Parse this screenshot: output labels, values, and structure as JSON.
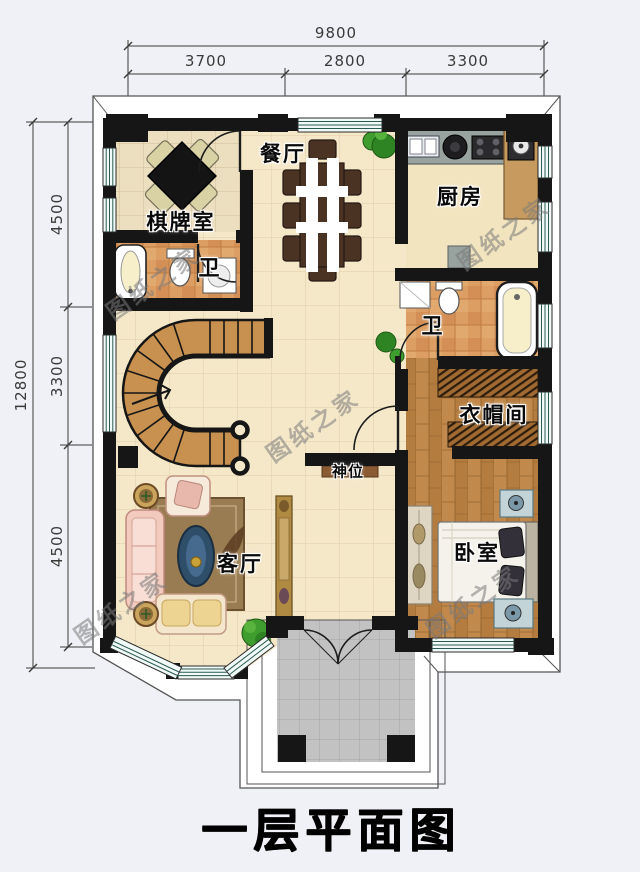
{
  "title": {
    "text": "一层平面图"
  },
  "watermark": {
    "text": "图纸之家",
    "color": "#7a7a7a"
  },
  "dimensions": {
    "top": {
      "total": "9800",
      "segments": [
        "3700",
        "2800",
        "3300"
      ]
    },
    "left": {
      "total": "12800",
      "segments": [
        "4500",
        "3300",
        "4500"
      ]
    }
  },
  "rooms": {
    "dining": "餐厅",
    "kitchen": "厨房",
    "game_room": "棋牌室",
    "bath1": "卫",
    "bath2": "卫",
    "cloakroom": "衣帽间",
    "shrine": "神位",
    "living": "客厅",
    "bedroom": "卧室"
  },
  "colors": {
    "wall": "#161616",
    "floor_base": "#f5e8c9",
    "bath_tile": "#dd9e63",
    "wood_floor": "#c18a4c",
    "porch": "#c2c2c2",
    "window_tint": "#f2faf8",
    "background": "#eff1f6"
  }
}
